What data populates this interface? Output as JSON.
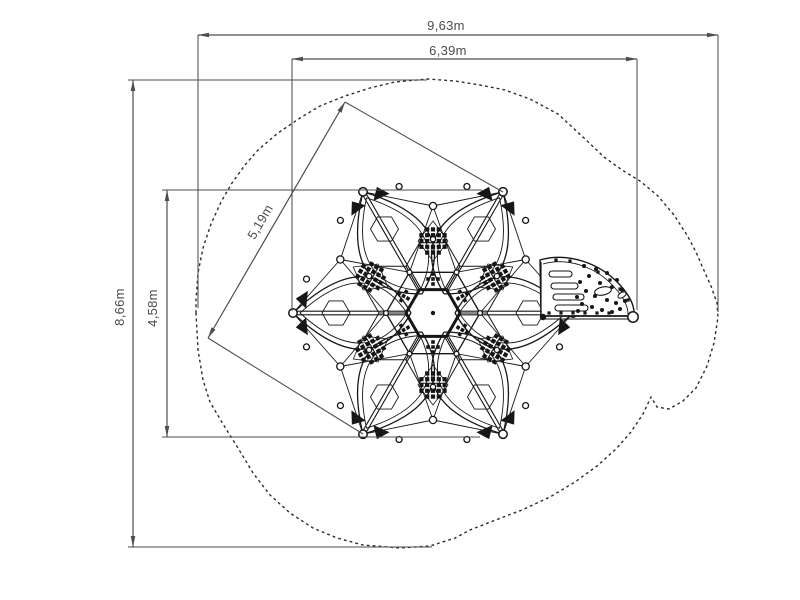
{
  "drawing": {
    "dimensions": {
      "overall_width": "9,63m",
      "inner_width": "6,39m",
      "overall_depth": "8,66m",
      "structure_depth": "4,58m",
      "structure_diagonal": "5,19m"
    },
    "colors": {
      "dimension_line": "#4d4d4d",
      "structure_line": "#161616",
      "safety_outline": "#2b2b2b",
      "background": "#ffffff"
    }
  }
}
